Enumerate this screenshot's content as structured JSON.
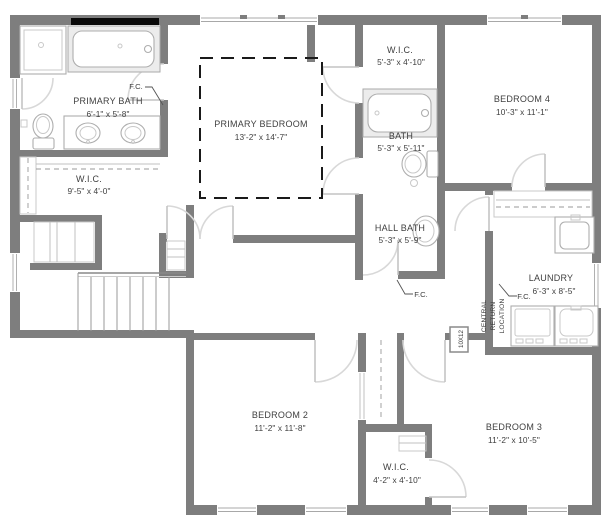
{
  "plan": {
    "title": "Second floor residential floor plan",
    "rooms": [
      {
        "name": "PRIMARY BATH",
        "dims": "6'-1\" x 5'-8\""
      },
      {
        "name": "PRIMARY BEDROOM",
        "dims": "13'-2\" x 14'-7\""
      },
      {
        "name": "W.I.C.",
        "dims": "9'-5\" x 4'-0\""
      },
      {
        "name": "W.I.C.",
        "dims": "5'-3\" x 4'-10\""
      },
      {
        "name": "BATH",
        "dims": "5'-3\" x 5'-11\""
      },
      {
        "name": "BEDROOM 4",
        "dims": "10'-3\" x 11'-1\""
      },
      {
        "name": "HALL BATH",
        "dims": "5'-3\" x 5'-9\""
      },
      {
        "name": "LAUNDRY",
        "dims": "6'-3\" x 8'-5\""
      },
      {
        "name": "BEDROOM 2",
        "dims": "11'-2\" x 11'-8\""
      },
      {
        "name": "BEDROOM 3",
        "dims": "11'-2\" x 10'-5\""
      },
      {
        "name": "W.I.C.",
        "dims": "4'-2\" x 4'-10\""
      }
    ],
    "annotations": {
      "fc1": "F.C.",
      "fc2": "F.C.",
      "fc3": "F.C.",
      "central_return": [
        "CENTRAL",
        "RETURN",
        "LOCATION"
      ],
      "duct_size": "10X12"
    },
    "colors": {
      "wall": "#7e7e7e",
      "fixture_stroke": "#aeaeae",
      "door_swing": "#d8d8d8",
      "label_text": "#404040",
      "tray_ceiling_dash": "#1a1a1a",
      "soffit_bar": "#000000"
    }
  }
}
